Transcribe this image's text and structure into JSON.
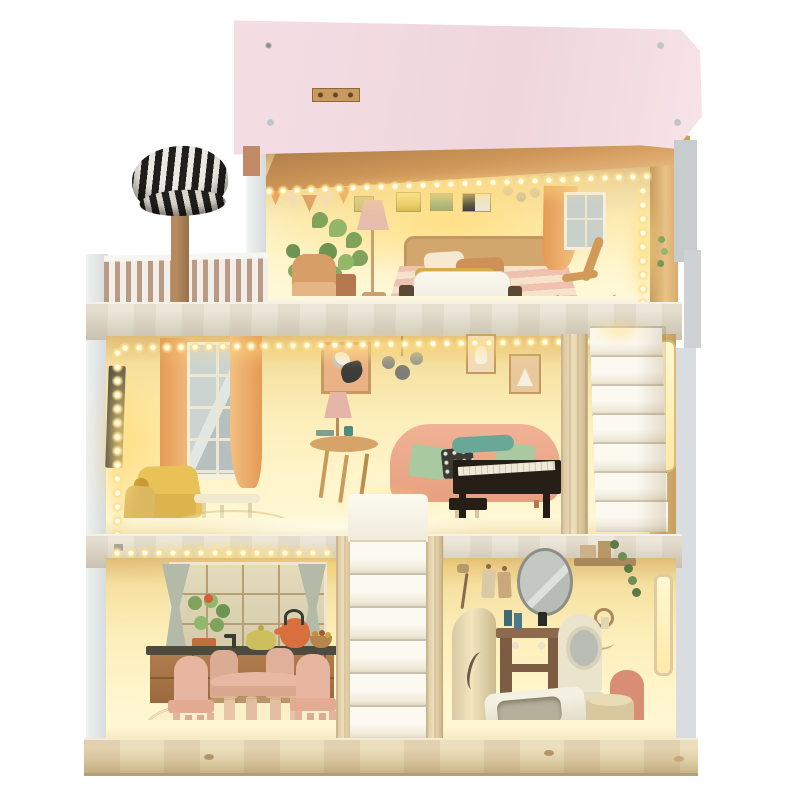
{
  "meta": {
    "description": "Product photo of a three-story wooden dollhouse on a white background: pale pink flat roof with metal screws, warm LED string lights along ceilings and walls, attic bedroom, left balcony with striped railing and striped-canopy tree, middle-floor living room with black piano and white staircase, ground floor kitchen with pink dining set and bathroom with tub, toilet and vanity, all on a pine base plank."
  },
  "palette": {
    "bg": "#ffffff",
    "roof_pink": "#f4dee4",
    "copper": "#cf9758",
    "copper_dark": "#7e5630",
    "wall_top": "#caa369",
    "wall_mid": "#fdefba",
    "wall_light": "#fff9d8",
    "led_core": "#fffef2",
    "led_halo": "#ffdf8a",
    "white_panel": "#f4f5f5",
    "gray_panel": "#c7ccce",
    "stripe_tan": "#bb9a85",
    "railing_white": "#f2efe8",
    "canopy_black": "#211f1b",
    "canopy_white": "#ece9e2",
    "trunk": "#b58a5e",
    "divider_wood": "#ddd7c7",
    "curtain_orange": "#e59a55",
    "frame_cream": "#f6efdc",
    "bed_tan": "#d2a76e",
    "panda_bg": "#eab285",
    "print_frame": "#c59a60",
    "sofa_pink": "#f1b295",
    "pillow_green": "#a9c9a0",
    "pillow_dark": "#3c3a34",
    "blanket_teal": "#69a896",
    "piano_black": "#241e17",
    "chair_yellow": "#e9c257",
    "table_tan": "#d6a468",
    "dining_pink": "#e8b8a2",
    "counter_brown": "#b07c4c",
    "counter_top": "#4e4a3e",
    "kettle_orange": "#d96f3c",
    "teapot_yellow": "#cdbf5e",
    "curtain_gray": "#b4baa8",
    "leaf_green": "#7fa35a",
    "leaf_dark": "#5c7a46",
    "pot_terracotta": "#b5774e",
    "step_white": "#fcf9f1",
    "mirror_gray": "#c3c8c2",
    "vanity_brown": "#8d6a4e",
    "cream_toy": "#ebe4cd",
    "tub_white": "#f4f0e2",
    "toilet_rose": "#d98d74",
    "toilet_tan": "#d9c79e",
    "base_wood": "#ecdfbd"
  },
  "scene": {
    "roof": {
      "screw_count": 4,
      "hinge_plate": true
    },
    "attic_bedroom": {
      "objects": [
        "led-string",
        "bunting-flags",
        "wall-prints",
        "wall-dots",
        "monstera-plants",
        "floor-lamp",
        "armchair",
        "painted-double-bed",
        "pillows",
        "orange-curtain",
        "window",
        "rocking-chair",
        "white-toy-bed"
      ]
    },
    "balcony": {
      "objects": [
        "striped-railing",
        "striped-canopy-tree"
      ]
    },
    "living_room": {
      "objects": [
        "vertical-led-strip",
        "wall-tv",
        "orange-curtains",
        "tall-window",
        "panda-picture",
        "chandelier",
        "rabbit-picture",
        "bear-picture",
        "table-lamp",
        "pedestal-table",
        "painted-pink-sofa",
        "toy-armchairs",
        "coffee-table",
        "black-piano",
        "piano-stool",
        "white-staircase",
        "lit-door-slot"
      ]
    },
    "kitchen": {
      "objects": [
        "grid-window",
        "gray-curtains",
        "potted-plant",
        "counter-with-sink",
        "faucet",
        "orange-kettle",
        "teapot",
        "fruit-bowl",
        "pink-round-table",
        "pink-chairs",
        "rug"
      ]
    },
    "bathroom": {
      "objects": [
        "painted-shower",
        "shower-stall",
        "towels",
        "oval-mirror",
        "vanity-table",
        "toiletries",
        "wall-shelf",
        "trailing-plant",
        "towel-ring",
        "mirror-stand",
        "bathtub",
        "toilet",
        "lit-window-slot"
      ]
    },
    "stairs": {
      "center": "white-staircase",
      "right": "white-staircase"
    },
    "base": "pine-wood-plank"
  }
}
